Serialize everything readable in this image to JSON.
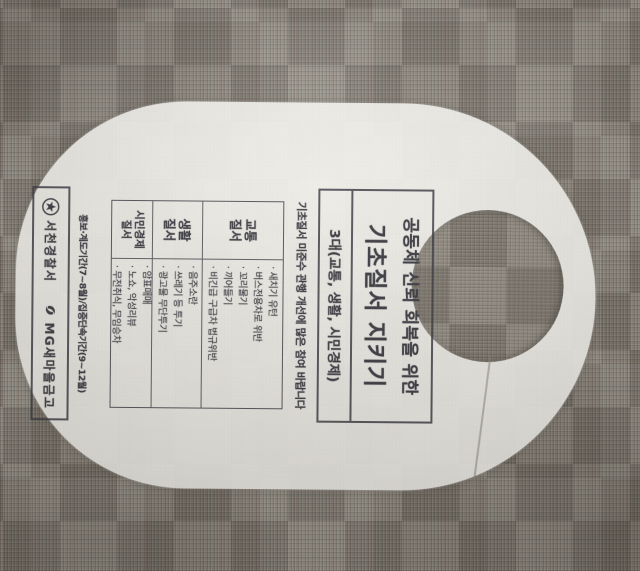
{
  "colors": {
    "paper": "#f6f5f0",
    "ink": "#3b3b42",
    "carpet_base": "#8b857b"
  },
  "hanger": {
    "title_line1": "공동체 신뢰 회복을 위한",
    "title_line2": "기초질서 지키기",
    "subtitle": "3대(교통, 생활, 시민경제)",
    "notice": "기초질서 미준수 관행 개선에 많은 참여 바랍니다",
    "table": {
      "rows": [
        {
          "category_line1": "교통",
          "category_line2": "질서",
          "items": [
            "새치기 유턴",
            "버스전용차로 위반",
            "꼬리물기",
            "끼어들기",
            "비긴급 구급차 법규위반"
          ]
        },
        {
          "category_line1": "생활",
          "category_line2": "질서",
          "items": [
            "음주소란",
            "쓰레기 등 투기",
            "광고물 무단투기"
          ]
        },
        {
          "category_line1": "시민경제",
          "category_line2": "질서",
          "items": [
            "암표매매",
            "노쇼, 악성리뷰",
            "무전취식, 무임승차"
          ]
        }
      ]
    },
    "period_notice": "홍보·계도기간(7~8월)/집중단속기간(9~12월)",
    "footer": {
      "police_name": "서천경찰서",
      "sponsor_name": "MG새마을금고"
    }
  }
}
